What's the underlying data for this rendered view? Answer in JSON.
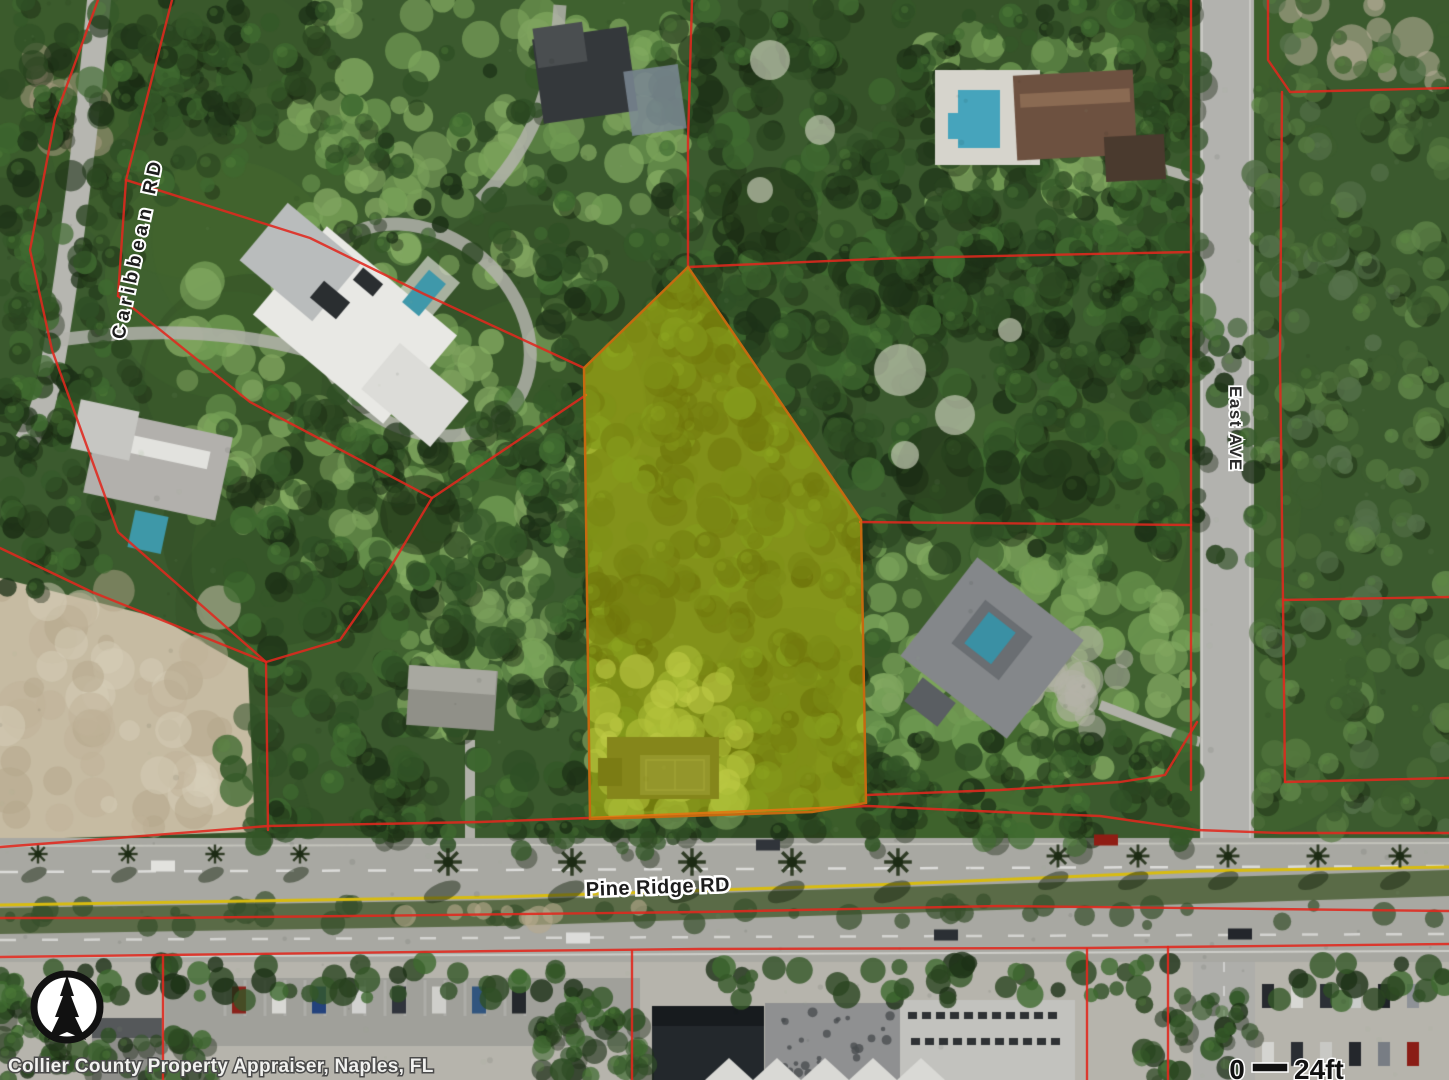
{
  "map": {
    "labels": {
      "caribbean_rd": "Caribbean RD",
      "east_ave": "East AVE",
      "pine_ridge_rd": "Pine Ridge RD"
    },
    "attribution": "Collier County Property Appraiser, Naples, FL",
    "scale_bar": {
      "start": "0",
      "end": "24ft"
    },
    "colors": {
      "parcel_line": "#e0281e",
      "highlight_fill": "#e8e000",
      "highlight_stroke": "#c56a10",
      "road_label_text": "#1c1c1c",
      "label_halo": "#ffffff",
      "median_line": "#d8bc10",
      "attribution_text": "#f2f2f0",
      "north_arrow_ink": "#111111"
    }
  }
}
